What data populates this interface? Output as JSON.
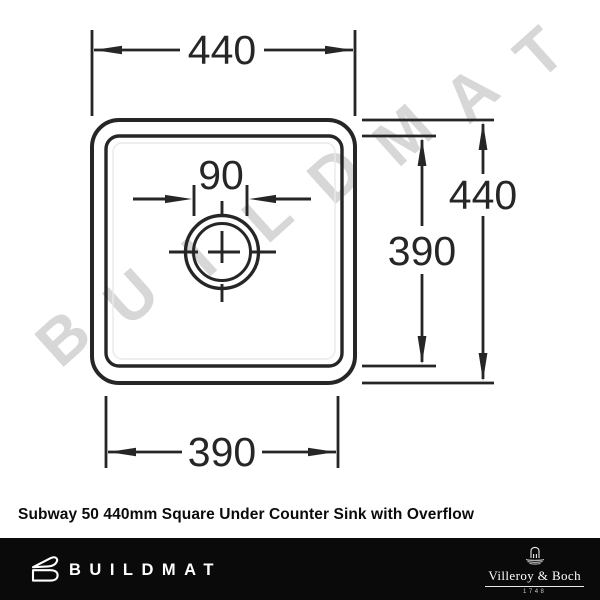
{
  "watermark": {
    "text": "BUILDMAT",
    "color": "#d7d7d7"
  },
  "drawing": {
    "dim_top_width": "440",
    "dim_right_outer_height": "440",
    "dim_right_inner_height": "390",
    "dim_bottom_inner_width": "390",
    "dim_drain_offset": "90"
  },
  "caption": "Subway 50 440mm Square Under Counter Sink with Overflow",
  "footer": {
    "brand": "BUILDMAT",
    "partner_name": "Villeroy & Boch",
    "partner_year": "1748"
  },
  "colors": {
    "line": "#262626",
    "footer_bg": "#0a0a0a",
    "watermark": "#d7d7d7"
  }
}
